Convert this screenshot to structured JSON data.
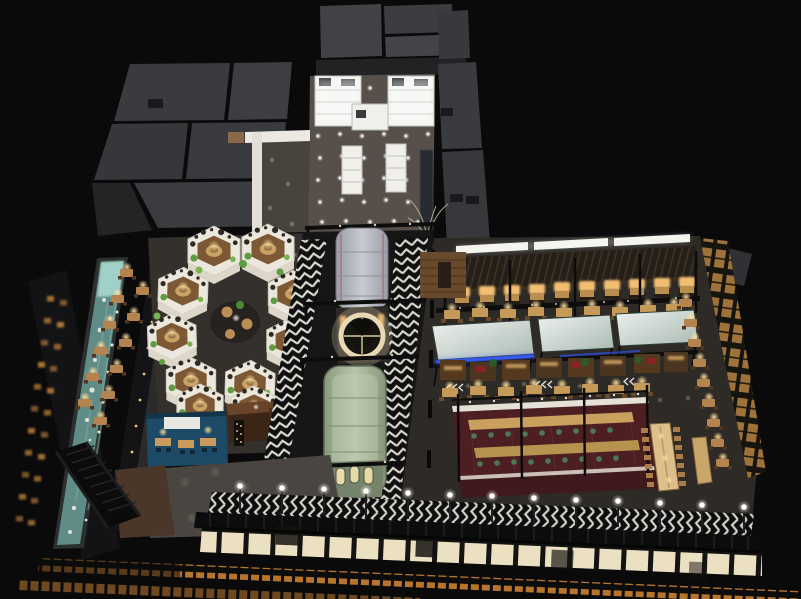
{
  "scene": {
    "title": "Night-time aerial 3D rendering of a food-hall restaurant interior",
    "type": "3d-architectural-rendering",
    "view": "isometric-overhead",
    "background_color": "#0a0a0b"
  },
  "palette": {
    "background": "#0a0a0b",
    "roof_panel": "#3a3b3d",
    "lobby_floor": "#564f4a",
    "pod_shell": "#ece7dd",
    "pod_wood": "#7c5834",
    "chevron_white": "#dcdcd4",
    "train_gray": "#b9bcc4",
    "train_green": "#9fae93",
    "clock_ring": "#e8d9b4",
    "canopy_teal": "#cfdad4",
    "neon_blue": "#2a52f0",
    "stall_wood": "#54391f",
    "bar_maroon": "#4e1f22",
    "table_wood": "#c59a58",
    "lamp_warm": "#ffdf9e",
    "stool_green": "#4a7a55",
    "water_teal": "#5f8c86",
    "water_head_aqua": "#a8d8d0",
    "glass_pane_warm": "#ece0c2",
    "facade_window_orange": "#c07a2e",
    "greenery": "#5e9c40"
  },
  "zones": [
    {
      "id": "roofscape",
      "label": "Rooftop service panels and tower roof"
    },
    {
      "id": "entrance-lobby",
      "label": "Entrance lobby with white retail kiosks and grid of downlights"
    },
    {
      "id": "hex-pods",
      "label": "Cluster of hexagonal white dining pods with planting",
      "pod_count": 10
    },
    {
      "id": "train-promenade",
      "label": "Chevron-floor promenade with two train-car diners and a round clock window",
      "train_car_count": 2
    },
    {
      "id": "food-hall",
      "label": "Food hall with booth rows, pale glass canopies, food stalls and table rows",
      "canopy_count": 3
    },
    {
      "id": "maroon-bar",
      "label": "Maroon communal bar with twin long tables and green stools"
    },
    {
      "id": "water-feature",
      "label": "Pebble-edged stream water feature"
    },
    {
      "id": "waterside-tables",
      "label": "Waterside lamp-lit tables for two",
      "table_count": 12
    },
    {
      "id": "blue-room",
      "label": "Blue private dining room"
    },
    {
      "id": "bar-counter",
      "label": "Dark wood service bar with bottle rack"
    },
    {
      "id": "balcony-edge",
      "label": "Balcony promenade edge with street lamps and railing",
      "street_lamp_count": 13
    },
    {
      "id": "glass-facade",
      "label": "Warm-lit glass facade band"
    },
    {
      "id": "orange-windows",
      "label": "Lower facade band of orange-lit windows"
    },
    {
      "id": "escalator",
      "label": "Escalator to lower floor"
    },
    {
      "id": "left-facade",
      "label": "Exterior side wall with small warm windows"
    }
  ]
}
